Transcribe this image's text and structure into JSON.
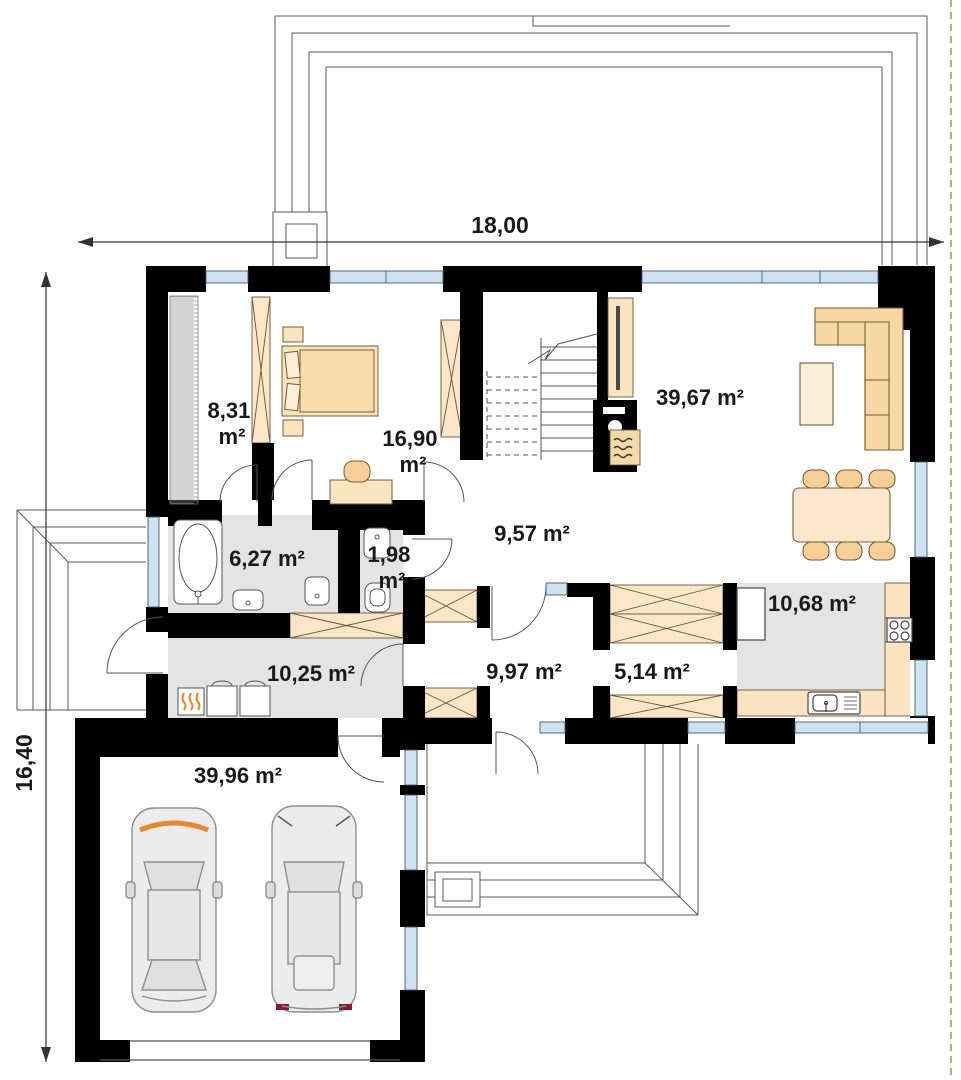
{
  "plan": {
    "dimensions": {
      "width": "18,00",
      "height": "16,40"
    },
    "rooms": [
      {
        "id": "wardrobe",
        "value": "8,31",
        "unit": "m²"
      },
      {
        "id": "bedroom",
        "value": "16,90",
        "unit": "m²"
      },
      {
        "id": "living-room",
        "value": "39,67",
        "unit": "m²"
      },
      {
        "id": "bathroom",
        "value": "6,27",
        "unit": "m²"
      },
      {
        "id": "wc",
        "value": "1,98",
        "unit": "m²"
      },
      {
        "id": "hall-upper",
        "value": "9,57",
        "unit": "m²"
      },
      {
        "id": "kitchen",
        "value": "10,68",
        "unit": "m²"
      },
      {
        "id": "utility",
        "value": "10,25",
        "unit": "m²"
      },
      {
        "id": "hall-lower",
        "value": "9,97",
        "unit": "m²"
      },
      {
        "id": "corridor",
        "value": "5,14",
        "unit": "m²"
      },
      {
        "id": "garage",
        "value": "39,96",
        "unit": "m²"
      }
    ],
    "colors": {
      "wall": "#000000",
      "window": "#cde3f1",
      "furniture": "#fbe5c1",
      "furniture_dark": "#f6ce96",
      "floor": "#e4e4e4",
      "flame": "#f0831e",
      "boundary": "#ab9d45",
      "taillight": "#8b1a2b"
    }
  }
}
